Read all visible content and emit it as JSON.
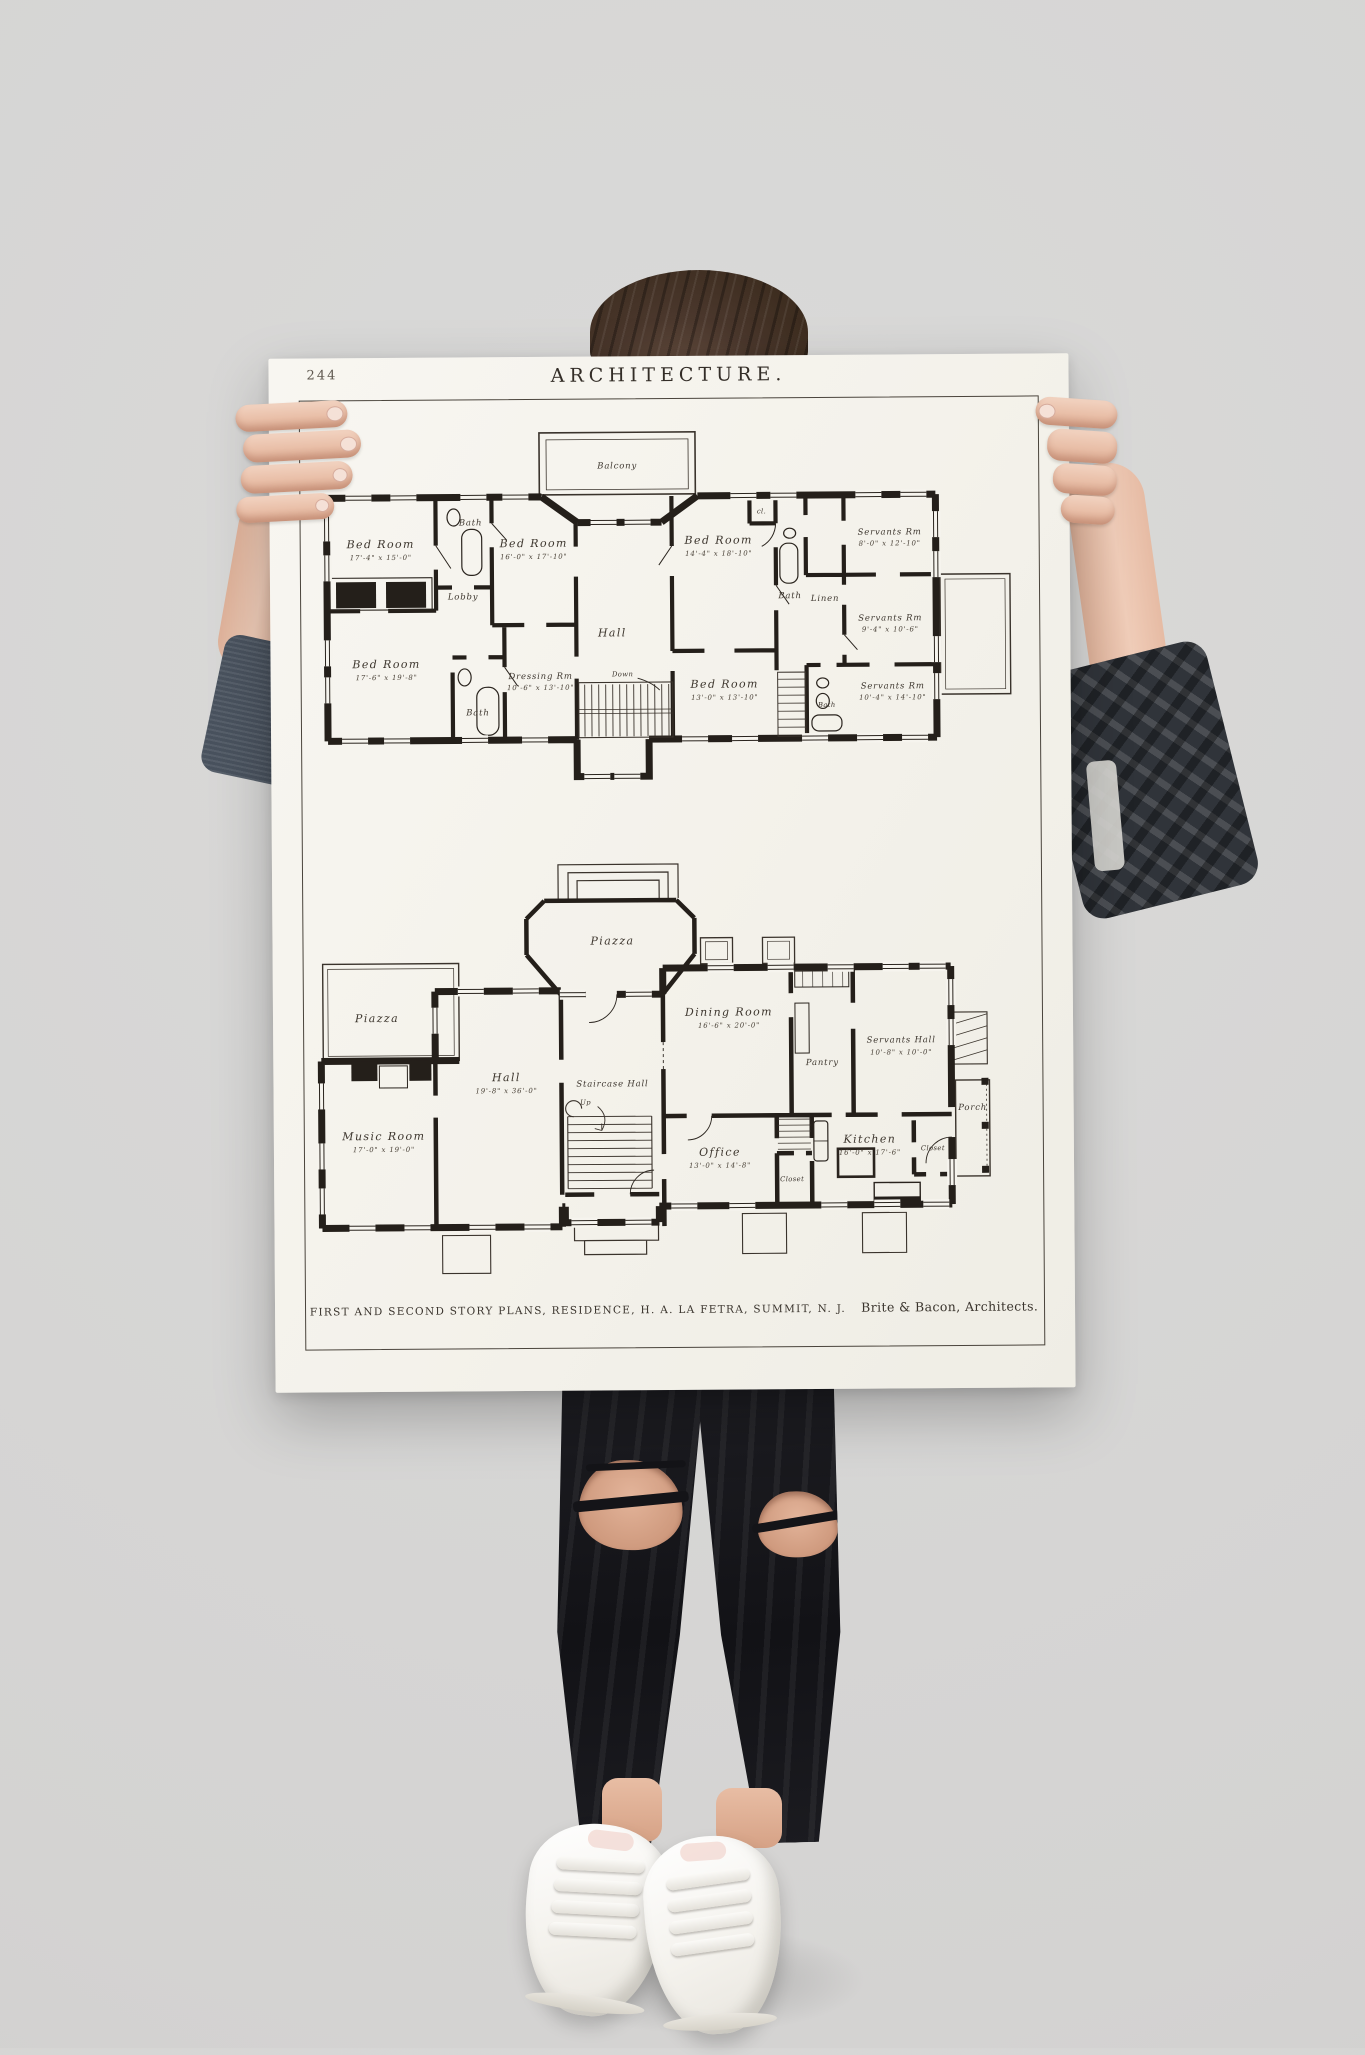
{
  "scene": {
    "background_color": "#d6d5d4",
    "poster_color": "#f6f4ee",
    "ink_color": "#26211c",
    "hair_color": "#4a372c",
    "skin_color": "#eac3ae",
    "jeans_color": "#15151a",
    "sneaker_color": "#f2efe9",
    "left_sleeve_color": "#49525e",
    "right_sleeve_color": "#30343a"
  },
  "poster": {
    "page_number": "244",
    "title": "ARCHITECTURE.",
    "caption": "FIRST AND SECOND STORY PLANS, RESIDENCE, H. A. LA FETRA, SUMMIT, N. J.",
    "caption_credit": "Brite & Bacon, Architects."
  },
  "second_story": {
    "balcony": "Balcony",
    "bed_room_nw": {
      "name": "Bed Room",
      "dims": "17'-4\" x 15'-0\""
    },
    "bath_nw": "Bath",
    "bed_room_n": {
      "name": "Bed Room",
      "dims": "16'-0\" x 17'-10\""
    },
    "lobby": "Lobby",
    "bed_room_ne": {
      "name": "Bed Room",
      "dims": "14'-4\" x 18'-10\""
    },
    "closet": "cl.",
    "bath_ne": "Bath",
    "servants_rm_ne": {
      "name": "Servants Rm",
      "dims": "8'-0\" x 12'-10\""
    },
    "linen": "Linen",
    "servants_rm_e": {
      "name": "Servants Rm",
      "dims": "9'-4\" x 10'-6\""
    },
    "hall": "Hall",
    "down": "Down",
    "bed_room_sw": {
      "name": "Bed Room",
      "dims": "17'-6\" x 19'-8\""
    },
    "bath_sw": "Bath",
    "dressing_rm": {
      "name": "Dressing Rm",
      "dims": "10'-6\" x 13'-10\""
    },
    "bed_room_s": {
      "name": "Bed Room",
      "dims": "13'-0\" x 13'-10\""
    },
    "bath_se": "Bath",
    "servants_rm_se": {
      "name": "Servants Rm",
      "dims": "10'-4\" x 14'-10\""
    }
  },
  "first_story": {
    "piazza_front": "Piazza",
    "piazza_side": "Piazza",
    "dining_room": {
      "name": "Dining Room",
      "dims": "16'-6\" x 20'-0\""
    },
    "pantry": "Pantry",
    "servants_hall": {
      "name": "Servants Hall",
      "dims": "10'-8\" x 10'-0\""
    },
    "hall": {
      "name": "Hall",
      "dims": "19'-8\" x 36'-0\""
    },
    "staircase_hall": "Staircase Hall",
    "porch": "Porch",
    "music_room": {
      "name": "Music Room",
      "dims": "17'-0\" x 19'-0\""
    },
    "up": "Up",
    "office": {
      "name": "Office",
      "dims": "13'-0\" x 14'-8\""
    },
    "closet_hall": "Closet",
    "kitchen": {
      "name": "Kitchen",
      "dims": "16'-0\" x 17'-6\""
    },
    "closet_kitchen": "Closet"
  }
}
